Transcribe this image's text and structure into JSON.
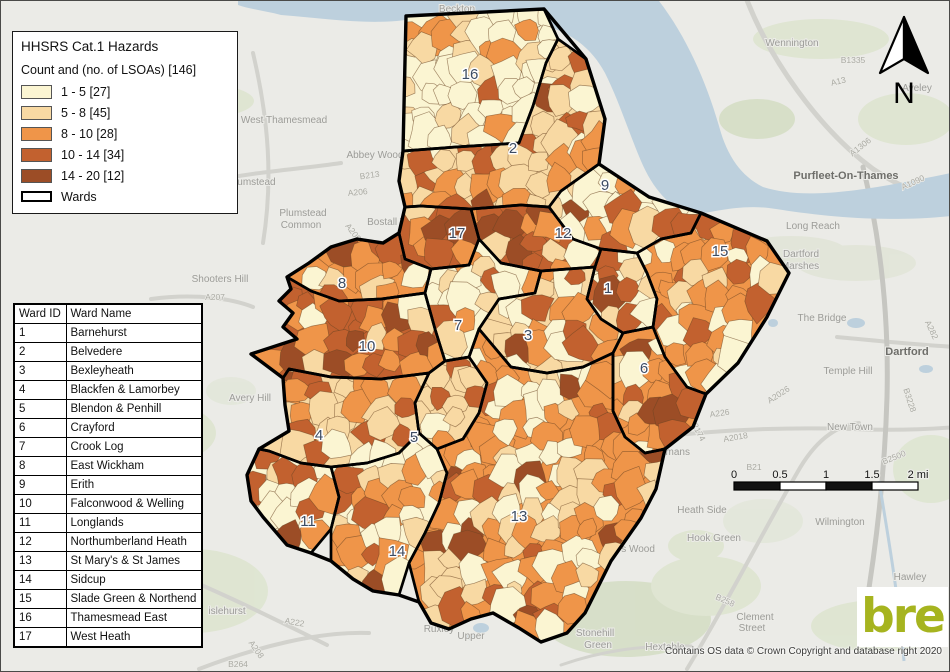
{
  "legend": {
    "title": "HHSRS Cat.1 Hazards",
    "subtitle": "Count and (no. of LSOAs)  [146]",
    "classes": [
      {
        "label": "1 - 5 [27]",
        "color": "#FBF5D2"
      },
      {
        "label": "5 - 8 [45]",
        "color": "#F8D9A3"
      },
      {
        "label": "8 - 10 [28]",
        "color": "#EF9549"
      },
      {
        "label": "10 - 14 [34]",
        "color": "#C2612F"
      },
      {
        "label": "14 - 20 [12]",
        "color": "#9C4D26"
      }
    ],
    "wards_label": "Wards"
  },
  "table": {
    "headers": [
      "Ward ID",
      "Ward Name"
    ],
    "rows": [
      [
        "1",
        "Barnehurst"
      ],
      [
        "2",
        "Belvedere"
      ],
      [
        "3",
        "Bexleyheath"
      ],
      [
        "4",
        "Blackfen & Lamorbey"
      ],
      [
        "5",
        "Blendon & Penhill"
      ],
      [
        "6",
        "Crayford"
      ],
      [
        "7",
        "Crook Log"
      ],
      [
        "8",
        "East Wickham"
      ],
      [
        "9",
        "Erith"
      ],
      [
        "10",
        "Falconwood & Welling"
      ],
      [
        "11",
        "Longlands"
      ],
      [
        "12",
        "Northumberland Heath"
      ],
      [
        "13",
        "St Mary's & St James"
      ],
      [
        "14",
        "Sidcup"
      ],
      [
        "15",
        "Slade Green & Northend"
      ],
      [
        "16",
        "Thamesmead East"
      ],
      [
        "17",
        "West Heath"
      ]
    ]
  },
  "north_label": "N",
  "scalebar": {
    "labels": [
      "0",
      "0.5",
      "1",
      "1.5",
      "2 mi"
    ]
  },
  "attribution": "Contains OS data © Crown Copyright and database right 2020",
  "logo_text": "bre",
  "colors": {
    "background": "#EBEBE7",
    "river": "#BDD0DD",
    "green": "#DEE5D0",
    "road": "#D2D2CD",
    "lsoa_line": "#6B4423",
    "ward_line": "#000000",
    "ward_label": "#3D4C63",
    "logo_green": "#A6B41F"
  },
  "map": {
    "outer": "405,15 543,8 585,58 604,118 598,163 648,196 700,212 766,240 788,272 766,316 737,362 705,393 692,426 664,448 655,488 640,517 610,560 584,612 566,632 540,641 518,627 492,612 470,618 448,628 430,622 418,601 398,594 372,590 352,578 330,560 310,552 286,544 262,516 250,500 246,474 258,448 288,430 284,404 282,377 250,353 296,338 282,326 292,312 278,300 290,288 286,276 308,262 330,246 356,238 382,242 398,232 404,206 398,180 402,150",
    "wards": [
      {
        "id": 16,
        "points": "405,15 543,8 557,38 545,62 532,105 518,142 455,146 402,150",
        "weights": [
          60,
          22,
          14,
          4,
          0
        ]
      },
      {
        "id": 2,
        "points": "402,150 455,146 518,142 532,105 545,62 557,38 585,58 604,118 598,163 560,190 548,206 520,204 470,208 420,205 404,206 398,180",
        "weights": [
          18,
          30,
          18,
          24,
          10
        ]
      },
      {
        "id": 9,
        "points": "598,163 648,196 700,212 690,232 660,238 636,252 600,248 572,238 548,206 560,190",
        "weights": [
          32,
          22,
          12,
          22,
          12
        ]
      },
      {
        "id": 17,
        "points": "398,232 404,206 420,205 470,208 478,238 468,264 430,268 404,258",
        "weights": [
          6,
          16,
          26,
          30,
          22
        ]
      },
      {
        "id": 12,
        "points": "470,208 520,204 548,206 572,238 600,248 594,266 540,270 500,262 478,238",
        "weights": [
          10,
          18,
          20,
          30,
          22
        ]
      },
      {
        "id": 15,
        "points": "660,238 690,232 700,212 766,240 788,272 766,316 737,362 705,393 686,386 664,356 652,326 656,298 646,272 636,252",
        "weights": [
          28,
          16,
          42,
          14,
          0
        ]
      },
      {
        "id": 1,
        "points": "594,266 600,248 636,252 646,272 656,298 652,326 622,332 600,318 586,298",
        "weights": [
          28,
          26,
          20,
          20,
          6
        ]
      },
      {
        "id": 8,
        "points": "286,276 308,262 330,246 356,238 382,242 398,232 404,258 430,268 424,292 380,298 338,300 310,290",
        "weights": [
          18,
          22,
          34,
          22,
          4
        ]
      },
      {
        "id": 7,
        "points": "430,268 468,264 478,238 500,262 540,270 534,292 498,298 478,328 468,356 444,360 434,328 424,292",
        "weights": [
          28,
          22,
          26,
          20,
          4
        ]
      },
      {
        "id": 3,
        "points": "540,270 594,266 586,298 600,318 622,332 612,352 582,366 546,372 510,366 478,328 498,298 534,292",
        "weights": [
          26,
          30,
          26,
          14,
          4
        ]
      },
      {
        "id": 10,
        "points": "286,276 310,290 338,300 380,298 424,292 434,328 444,360 428,372 380,378 330,376 288,368 282,377 250,353 296,338 282,326 292,312 278,300 290,288",
        "weights": [
          6,
          16,
          30,
          32,
          16
        ]
      },
      {
        "id": 6,
        "points": "622,332 652,326 664,356 686,386 705,393 692,426 664,448 644,452 624,436 612,410 612,352",
        "weights": [
          24,
          14,
          28,
          14,
          20
        ]
      },
      {
        "id": 5,
        "points": "428,372 444,360 468,356 486,382 478,412 462,438 436,448 418,432 414,402",
        "weights": [
          16,
          30,
          28,
          22,
          4
        ]
      },
      {
        "id": 4,
        "points": "282,377 288,368 330,376 380,378 428,372 414,402 418,432 398,452 366,462 330,466 300,462 268,450 258,448 288,430 284,404",
        "weights": [
          16,
          28,
          28,
          24,
          4
        ]
      },
      {
        "id": 11,
        "points": "258,448 268,450 300,462 330,466 338,496 330,528 310,552 286,544 262,516 250,500 246,474",
        "weights": [
          34,
          12,
          20,
          30,
          4
        ]
      },
      {
        "id": 14,
        "points": "330,466 366,462 398,452 418,432 436,448 446,472 438,502 424,532 408,562 398,594 372,590 352,578 330,560 330,528 338,496",
        "weights": [
          26,
          22,
          24,
          24,
          4
        ]
      },
      {
        "id": 13,
        "points": "478,328 510,366 546,372 582,366 612,352 612,410 624,436 644,452 664,448 655,488 640,517 610,560 584,612 566,632 540,641 518,627 492,612 470,618 448,628 430,622 418,601 408,562 424,532 438,502 446,472 436,448 462,438 478,412 486,382 468,356",
        "weights": [
          32,
          18,
          36,
          8,
          6
        ]
      }
    ],
    "ward_labels": [
      {
        "id": "16",
        "x": 469,
        "y": 78
      },
      {
        "id": "2",
        "x": 512,
        "y": 152
      },
      {
        "id": "9",
        "x": 604,
        "y": 189
      },
      {
        "id": "17",
        "x": 456,
        "y": 237
      },
      {
        "id": "12",
        "x": 562,
        "y": 237
      },
      {
        "id": "15",
        "x": 719,
        "y": 255
      },
      {
        "id": "8",
        "x": 341,
        "y": 287
      },
      {
        "id": "1",
        "x": 607,
        "y": 292
      },
      {
        "id": "7",
        "x": 457,
        "y": 329
      },
      {
        "id": "3",
        "x": 527,
        "y": 339
      },
      {
        "id": "10",
        "x": 366,
        "y": 350
      },
      {
        "id": "6",
        "x": 643,
        "y": 372
      },
      {
        "id": "4",
        "x": 318,
        "y": 439
      },
      {
        "id": "5",
        "x": 413,
        "y": 441
      },
      {
        "id": "13",
        "x": 518,
        "y": 520
      },
      {
        "id": "11",
        "x": 307,
        "y": 525
      },
      {
        "id": "14",
        "x": 396,
        "y": 555
      }
    ],
    "background_labels": [
      {
        "text": "Beckton",
        "x": 456,
        "y": 11,
        "cls": "place"
      },
      {
        "text": "Wennington",
        "x": 791,
        "y": 45,
        "cls": "place"
      },
      {
        "text": "Aveley",
        "x": 916,
        "y": 90,
        "cls": "place"
      },
      {
        "text": "West Thamesmead",
        "x": 283,
        "y": 122,
        "cls": "place"
      },
      {
        "text": "Abbey Wood",
        "x": 374,
        "y": 157,
        "cls": "place"
      },
      {
        "text": "Plumstead",
        "x": 251,
        "y": 184,
        "cls": "place"
      },
      {
        "text": "Purfleet-On-Thames",
        "x": 845,
        "y": 178,
        "cls": "place2"
      },
      {
        "text": "Long Reach",
        "x": 812,
        "y": 228,
        "cls": "place"
      },
      {
        "text": "Dartford",
        "x": 800,
        "y": 256,
        "cls": "place"
      },
      {
        "text": "Marshes",
        "x": 799,
        "y": 268,
        "cls": "place"
      },
      {
        "text": "Plumstead",
        "x": 302,
        "y": 215,
        "cls": "place"
      },
      {
        "text": "Common",
        "x": 300,
        "y": 227,
        "cls": "place"
      },
      {
        "text": "Bostall Woods",
        "x": 398,
        "y": 224,
        "cls": "place"
      },
      {
        "text": "Shooters Hill",
        "x": 219,
        "y": 281,
        "cls": "place"
      },
      {
        "text": "The Bridge",
        "x": 821,
        "y": 320,
        "cls": "place"
      },
      {
        "text": "Dartford",
        "x": 906,
        "y": 354,
        "cls": "place2"
      },
      {
        "text": "Temple Hill",
        "x": 847,
        "y": 373,
        "cls": "place"
      },
      {
        "text": "Avery Hill",
        "x": 249,
        "y": 400,
        "cls": "place"
      },
      {
        "text": "New Town",
        "x": 849,
        "y": 429,
        "cls": "place"
      },
      {
        "text": "Bowmans",
        "x": 667,
        "y": 454,
        "cls": "place"
      },
      {
        "text": "Maypole",
        "x": 629,
        "y": 505,
        "cls": "place"
      },
      {
        "text": "Heath Side",
        "x": 701,
        "y": 512,
        "cls": "place"
      },
      {
        "text": "Hook Green",
        "x": 713,
        "y": 540,
        "cls": "place"
      },
      {
        "text": "Wilmington",
        "x": 839,
        "y": 524,
        "cls": "place"
      },
      {
        "text": "Joyden's Wood",
        "x": 620,
        "y": 551,
        "cls": "place"
      },
      {
        "text": "Stonehill",
        "x": 594,
        "y": 635,
        "cls": "place"
      },
      {
        "text": "Green",
        "x": 597,
        "y": 647,
        "cls": "place"
      },
      {
        "text": "Hextable",
        "x": 664,
        "y": 649,
        "cls": "place"
      },
      {
        "text": "Clement",
        "x": 754,
        "y": 619,
        "cls": "place"
      },
      {
        "text": "Street",
        "x": 751,
        "y": 630,
        "cls": "place"
      },
      {
        "text": "Darenth",
        "x": 929,
        "y": 594,
        "cls": "place"
      },
      {
        "text": "Hawley",
        "x": 909,
        "y": 579,
        "cls": "place"
      },
      {
        "text": "islehurst",
        "x": 226,
        "y": 613,
        "cls": "place"
      },
      {
        "text": "Ruxley",
        "x": 438,
        "y": 631,
        "cls": "place"
      },
      {
        "text": "Upper",
        "x": 470,
        "y": 638,
        "cls": "place"
      },
      {
        "text": "B1335",
        "x": 852,
        "y": 62,
        "cls": "road"
      },
      {
        "text": "A13",
        "x": 838,
        "y": 83,
        "cls": "road",
        "rot": -14
      },
      {
        "text": "A1306",
        "x": 861,
        "y": 148,
        "cls": "road",
        "rot": -38
      },
      {
        "text": "A1090",
        "x": 913,
        "y": 184,
        "cls": "road",
        "rot": -24
      },
      {
        "text": "B213",
        "x": 369,
        "y": 177,
        "cls": "road",
        "rot": -8
      },
      {
        "text": "A206",
        "x": 357,
        "y": 194,
        "cls": "road",
        "rot": -6
      },
      {
        "text": "A209",
        "x": 350,
        "y": 233,
        "cls": "road",
        "rot": 52
      },
      {
        "text": "A207",
        "x": 214,
        "y": 299,
        "cls": "road"
      },
      {
        "text": "A2026",
        "x": 779,
        "y": 396,
        "cls": "road",
        "rot": -33
      },
      {
        "text": "A226",
        "x": 719,
        "y": 415,
        "cls": "road",
        "rot": -8
      },
      {
        "text": "B2174",
        "x": 694,
        "y": 430,
        "cls": "road",
        "rot": 62
      },
      {
        "text": "A2018",
        "x": 735,
        "y": 439,
        "cls": "road",
        "rot": -10
      },
      {
        "text": "B3228",
        "x": 906,
        "y": 400,
        "cls": "road",
        "rot": 72
      },
      {
        "text": "A282",
        "x": 928,
        "y": 330,
        "cls": "road",
        "rot": 65
      },
      {
        "text": "B2500",
        "x": 894,
        "y": 459,
        "cls": "road",
        "rot": -22
      },
      {
        "text": "B21",
        "x": 753,
        "y": 469,
        "cls": "road"
      },
      {
        "text": "A222",
        "x": 293,
        "y": 624,
        "cls": "road",
        "rot": 10
      },
      {
        "text": "A208",
        "x": 253,
        "y": 650,
        "cls": "road",
        "rot": 55
      },
      {
        "text": "B264",
        "x": 237,
        "y": 666,
        "cls": "road"
      },
      {
        "text": "B258",
        "x": 723,
        "y": 602,
        "cls": "road",
        "rot": 24
      }
    ]
  }
}
